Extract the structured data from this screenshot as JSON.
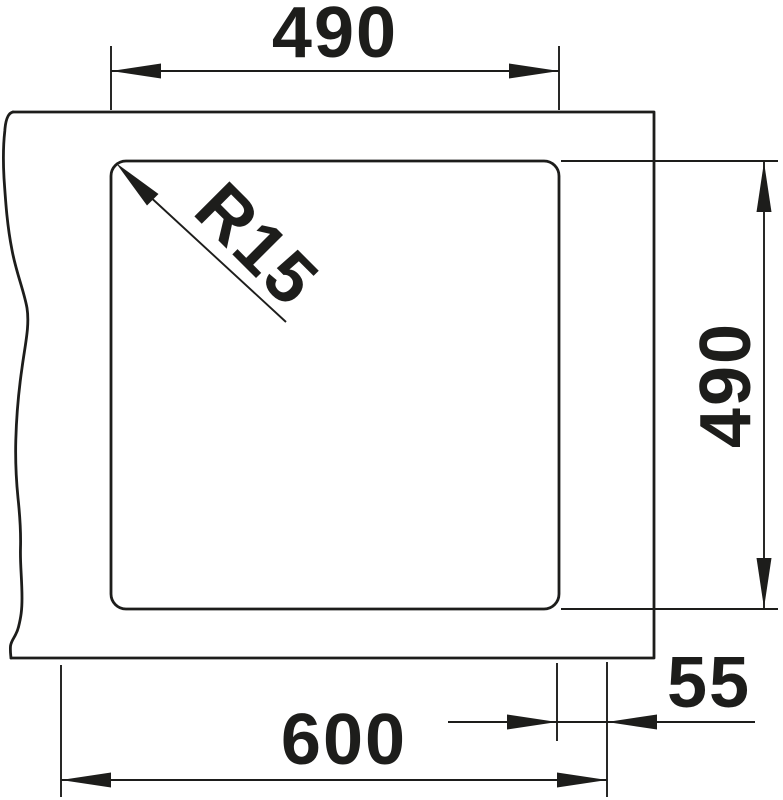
{
  "diagram": {
    "kind": "sink technical dimension drawing, top view",
    "labels": {
      "top_width": "490",
      "right_height": "490",
      "bottom_width": "600",
      "right_offset": "55",
      "corner_radius": "R15"
    },
    "colors": {
      "line": "#1d1d1b",
      "background": "#ffffff"
    }
  }
}
